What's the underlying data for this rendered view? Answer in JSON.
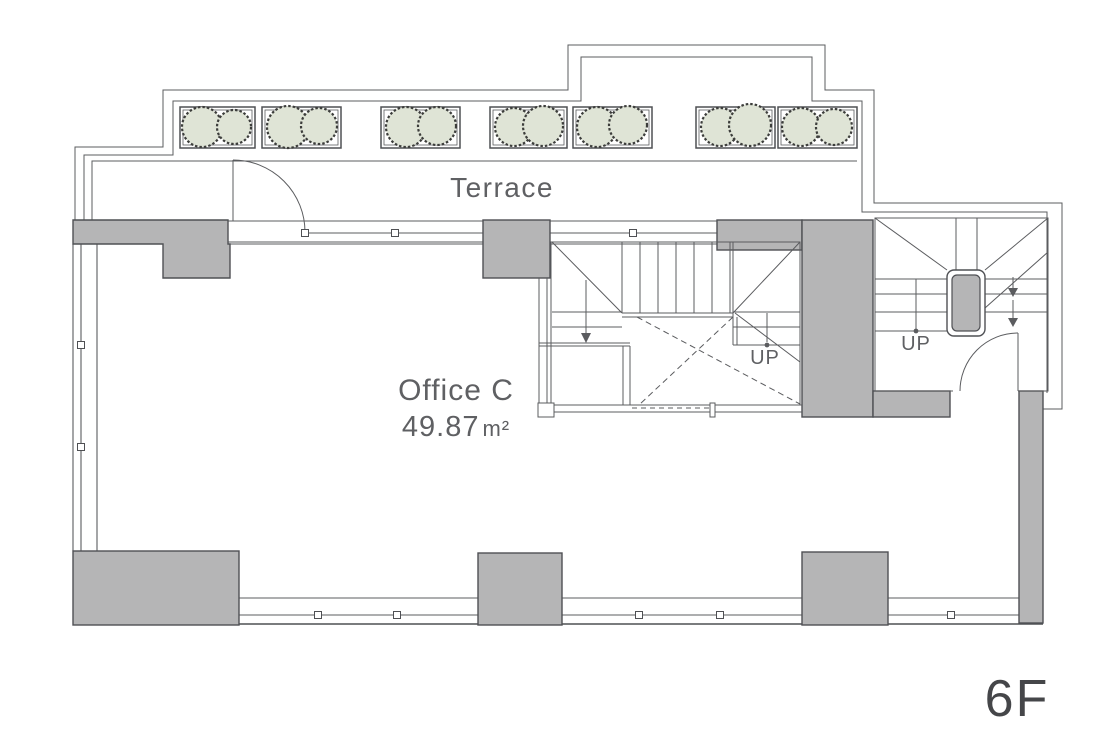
{
  "floor_plan": {
    "terrace_label": "Terrace",
    "office": {
      "name": "Office C",
      "area_value": "49.87",
      "area_unit": "m²"
    },
    "stairs": {
      "up_label_middle": "UP",
      "up_label_right": "UP"
    },
    "floor_label": "6F"
  },
  "colors": {
    "background": "#ffffff",
    "wall_fill": "#b5b5b6",
    "line": "#4f5054",
    "line_thin": "#5b5c5f",
    "planter_green": "#dfe4d6",
    "bush_stroke": "#3c3d3b",
    "text": "#5f6063",
    "floor_label_color": "#454649"
  }
}
